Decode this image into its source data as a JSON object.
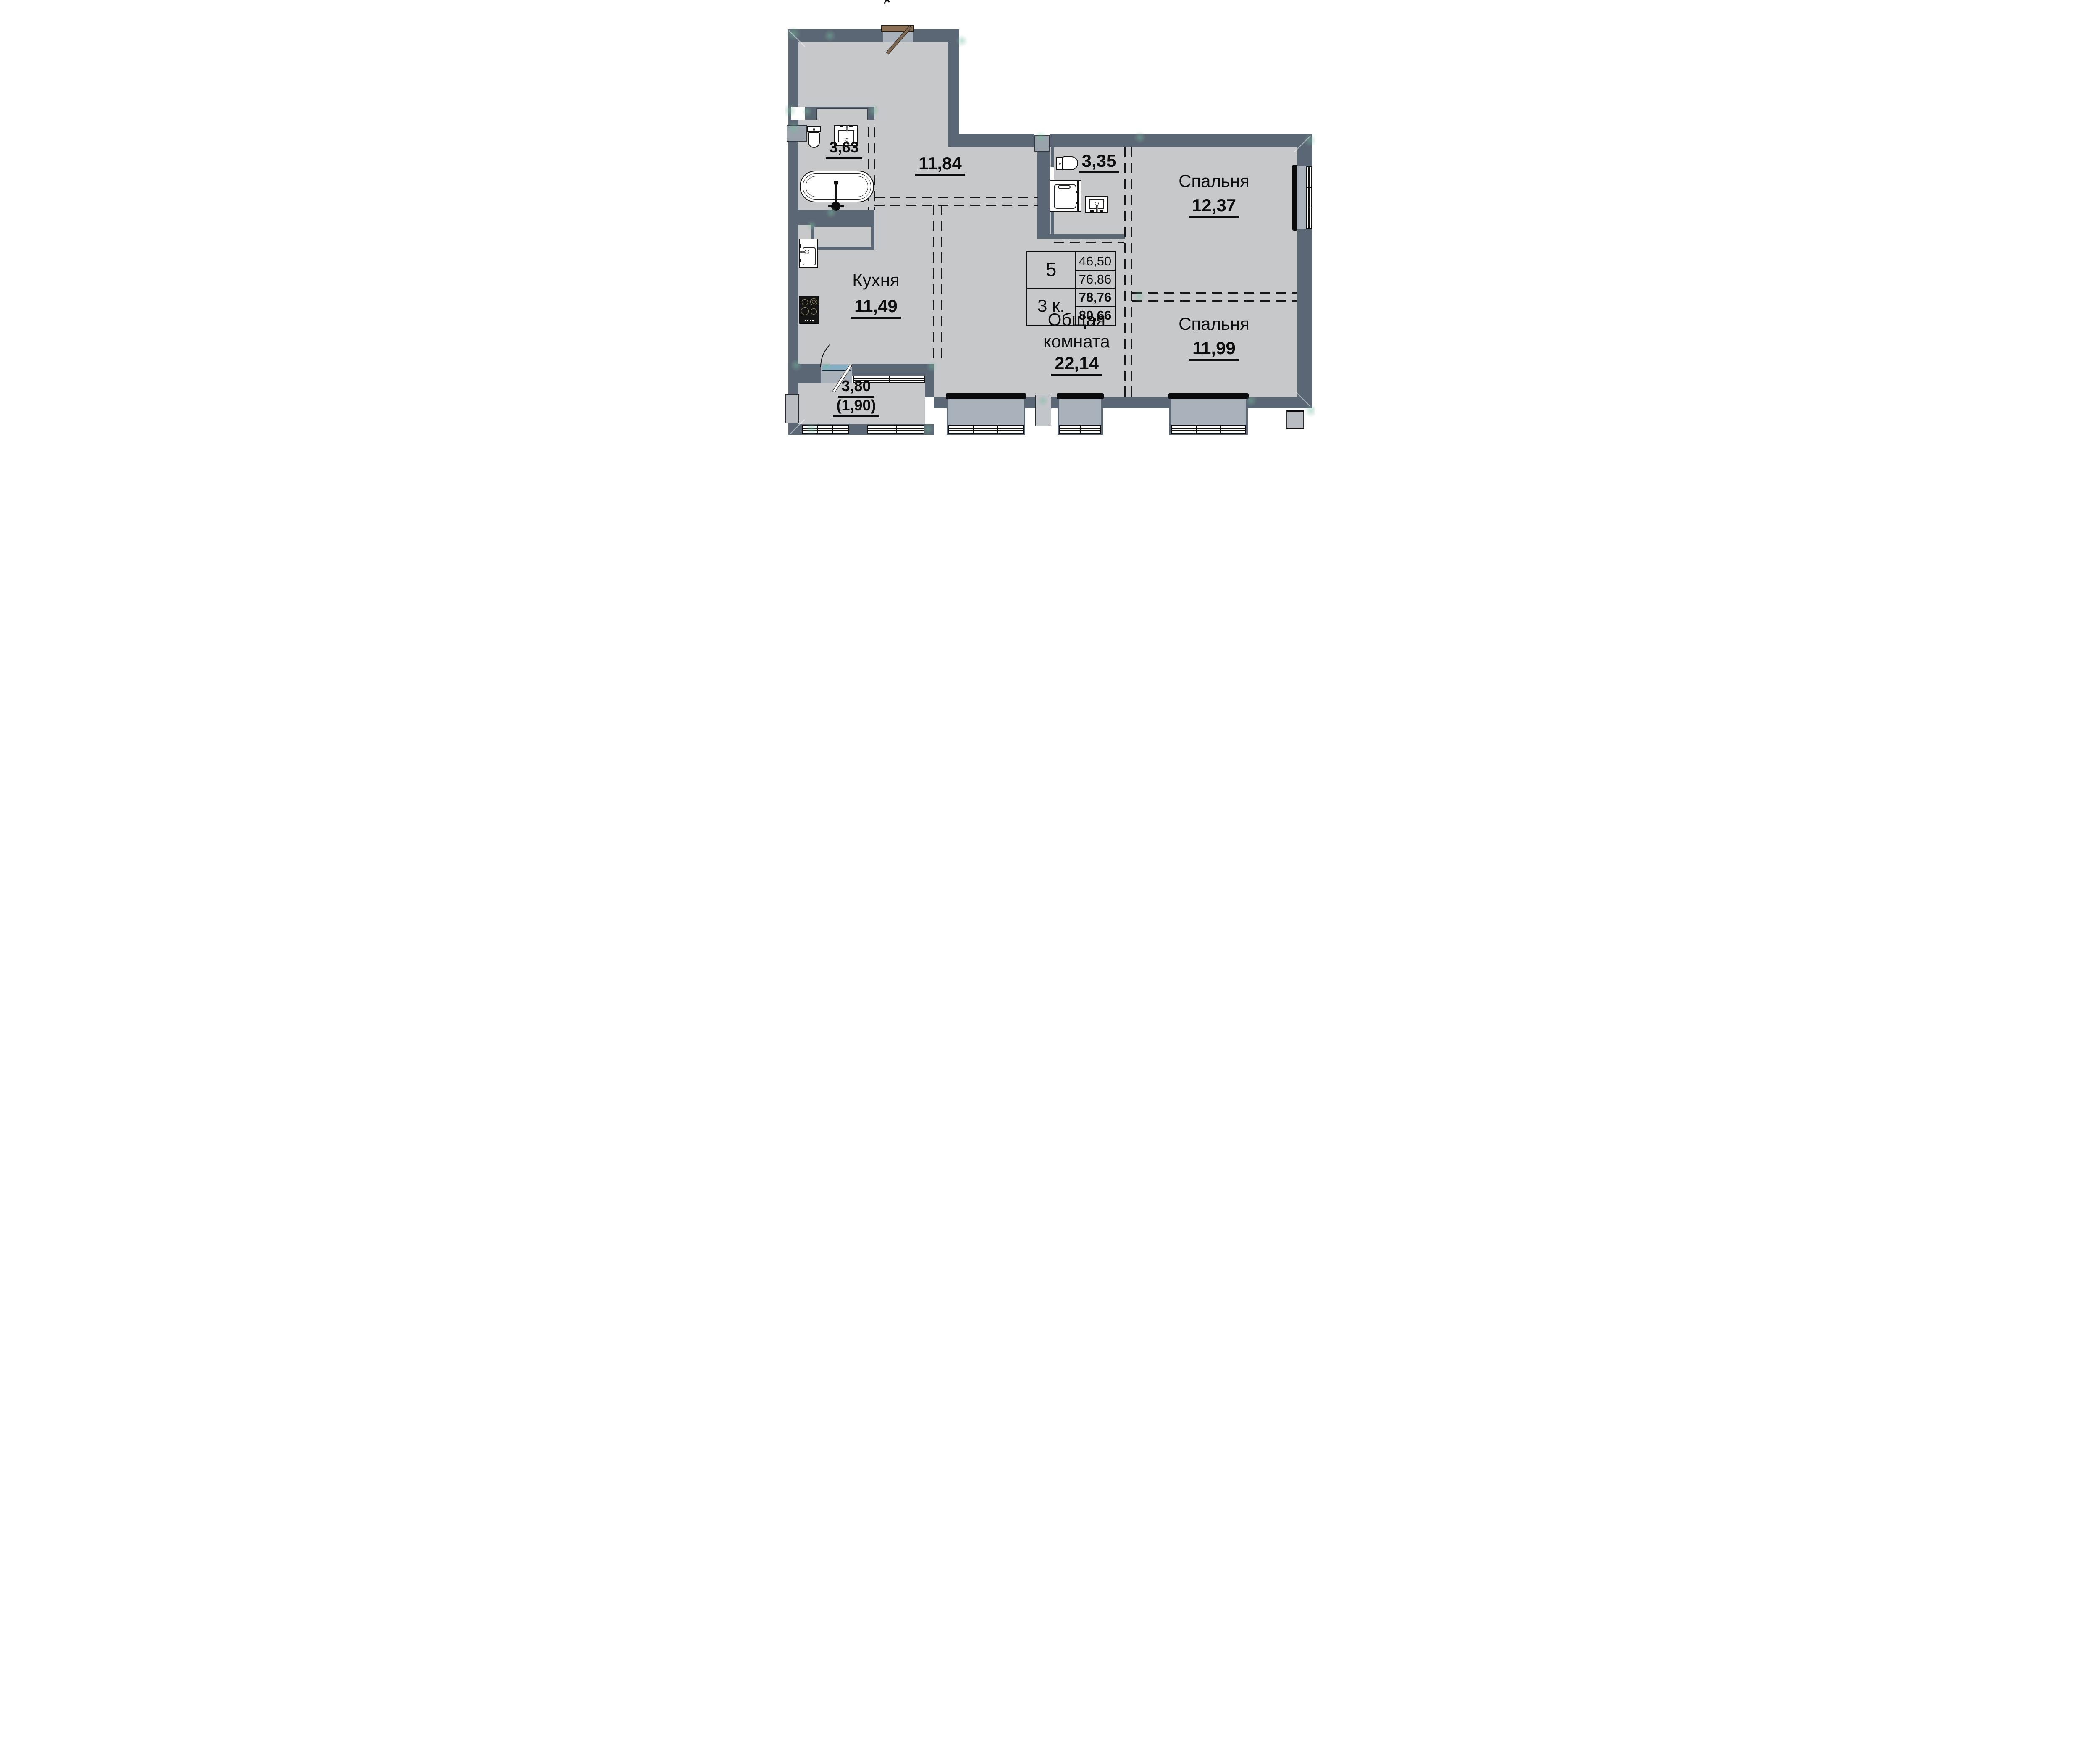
{
  "plan": {
    "title": "apartment floor plan, 3-room flat no. 5",
    "colors": {
      "wall": "#5b6774",
      "floor": "#c7c8ca",
      "window_recess": "#a9b1ba",
      "lintel_black": "#0b0b0b",
      "door_brown": "#7a6650",
      "balcony_sill_blue": "#85aec2",
      "watermark_teal": "rgba(120,190,162,0.45)"
    },
    "rooms": {
      "bathroom": {
        "area": "3,63"
      },
      "hallway": {
        "area": "11,84"
      },
      "wc": {
        "area": "3,35"
      },
      "bedroom1": {
        "name": "Спальня",
        "area": "12,37"
      },
      "kitchen": {
        "name": "Кухня",
        "area": "11,49"
      },
      "living": {
        "name_line1": "Общая",
        "name_line2": "комната",
        "area": "22,14"
      },
      "bedroom2": {
        "name": "Спальня",
        "area": "11,99"
      },
      "balcony": {
        "area": "3,80",
        "area_reduced": "(1,90)"
      }
    },
    "info_table": {
      "apartment_number": "5",
      "rooms_count": "3 к.",
      "living_area": "46,50",
      "area_no_balcony": "76,86",
      "area_project": "78,76",
      "area_total": "80,66"
    }
  }
}
